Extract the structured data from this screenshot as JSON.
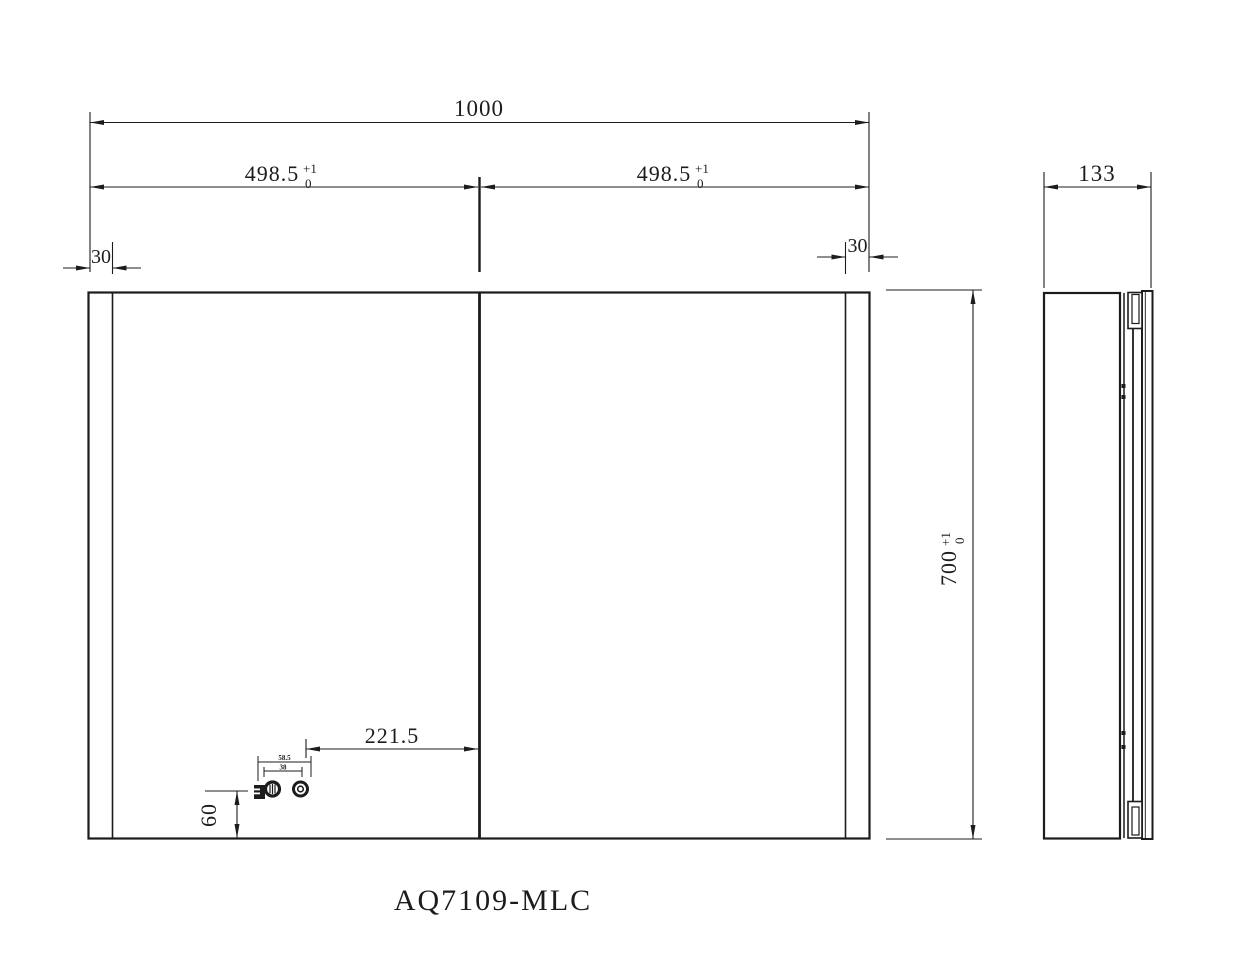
{
  "title": "AQ7109-MLC",
  "colors": {
    "line": "#1c1c1c",
    "background": "#ffffff"
  },
  "front_view": {
    "dims": {
      "total_width": {
        "value": "1000"
      },
      "half_width_left": {
        "value": "498.5",
        "tol_sup": "+1",
        "tol_sub": "0"
      },
      "half_width_right": {
        "value": "498.5",
        "tol_sup": "+1",
        "tol_sub": "0"
      },
      "edge_left": {
        "value": "30"
      },
      "edge_right": {
        "value": "30"
      },
      "height": {
        "value": "700",
        "tol_sup": "+1",
        "tol_sub": "0"
      },
      "control_offset_x": {
        "value": "221.5"
      },
      "control_offset_y": {
        "value": "60"
      },
      "control_span_outer": {
        "value": "58.5"
      },
      "control_span_inner": {
        "value": "38"
      }
    }
  },
  "side_view": {
    "dims": {
      "depth": {
        "value": "133"
      }
    }
  }
}
